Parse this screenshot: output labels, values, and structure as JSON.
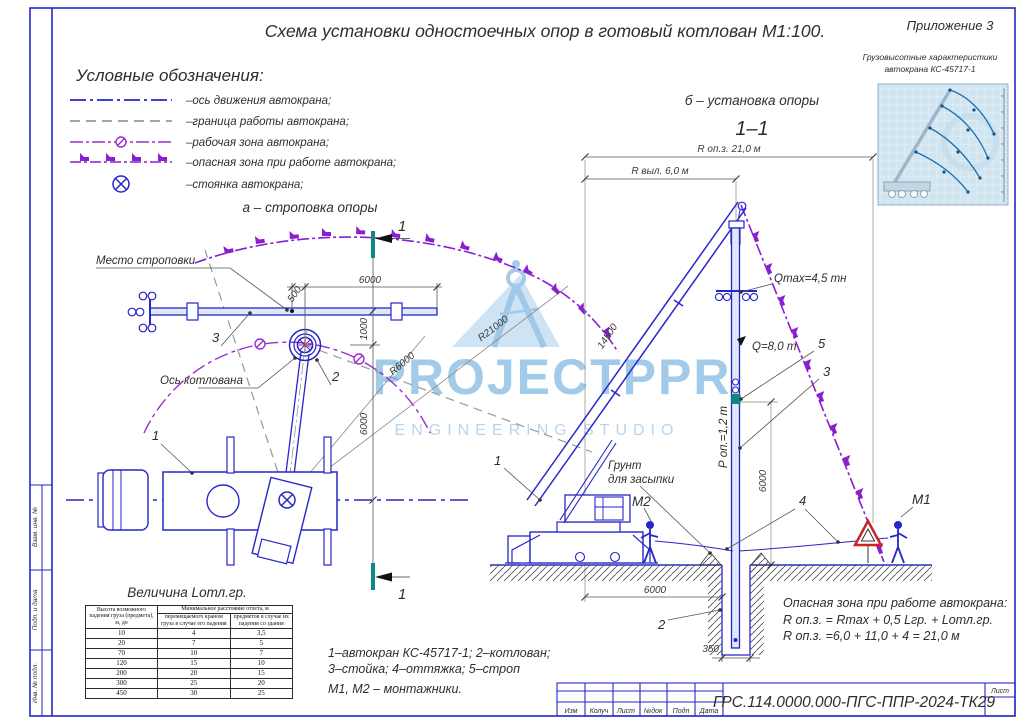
{
  "sheet": {
    "appendix": "Приложение 3",
    "title": "Схема установки одностоечных опор в готовый котлован М1:100.",
    "doc_number": "ГРС.114.0000.000-ПГС-ППР-2024-ТК29",
    "sheet_label": "Лист",
    "stamp_columns": [
      "Изм",
      "Колуч",
      "Лист",
      "№док",
      "Подп",
      "Дата"
    ],
    "side_fields": [
      "Взам. инв. №",
      "Подп. и дата",
      "Инв. № подл."
    ]
  },
  "legend": {
    "header": "Условные обозначения:",
    "items": [
      "–ось движения  автокрана;",
      "–граница работы автокрана;",
      "–рабочая зона автокрана;",
      "–опасная зона при работе автокрана;",
      "–стоянка автокрана;"
    ]
  },
  "crane_chart": {
    "title_line1": "Грузовысотные характеристики",
    "title_line2": "автокрана КС-45717-1"
  },
  "plan": {
    "subtitle": "а – строповка опоры",
    "sling_label": "Место строповки",
    "pit_axis_label": "Ось котлована",
    "dim_500": "500",
    "dim_6000_top": "6000",
    "dim_1000": "1000",
    "dim_6000_side": "6000",
    "r6000": "R6000",
    "r21000": "R21000",
    "callout_1": "1",
    "callout_2": "2",
    "callout_3": "3",
    "section_mark": "1"
  },
  "section": {
    "subtitle": "б – установка опоры",
    "view_label": "1–1",
    "dim_r_opz": "R оп.з. 21,0 м",
    "dim_r_vyl": "R выл. 6,0 м",
    "boom_length": "14500",
    "qmax": "Qmax=4,5 тн",
    "q_load": "Q=8,0 т",
    "p_op": "Р оп.=1,2 т",
    "soil_line1": "Грунт",
    "soil_line2": "для засыпки",
    "worker_m2": "М2",
    "worker_m1": "М1",
    "dim_6000_v": "6000",
    "dim_6000_h": "6000",
    "dim_350": "350",
    "callout_1": "1",
    "callout_2": "2",
    "callout_3": "3",
    "callout_4": "4",
    "callout_5": "5"
  },
  "danger_note": {
    "line1": "Опасная зона при работе автокрана:",
    "line2": "R оп.з. = Rmax + 0,5 Lгр. + Lотл.гр.",
    "line3": "R оп.з. =6,0 + 11,0 + 4 = 21,0 м"
  },
  "notes": {
    "line1": "1–автокран КС-45717-1; 2–котлован;",
    "line2": "3–стойка; 4–оттяжка; 5–строп",
    "line3": "М1, М2 – монтажники."
  },
  "offset_table": {
    "title": "Величина Lотл.гр.",
    "col1_header": "Высота возможного падения груза (предмета), м, до",
    "span_header": "Минимальное расстояние отлета, м",
    "col2_header": "перемещаемого краном груза в случае его падения",
    "col3_header": "предметов в случае их падения со здания",
    "rows": [
      [
        "10",
        "4",
        "3,5"
      ],
      [
        "20",
        "7",
        "5"
      ],
      [
        "70",
        "10",
        "7"
      ],
      [
        "120",
        "15",
        "10"
      ],
      [
        "200",
        "20",
        "15"
      ],
      [
        "300",
        "25",
        "20"
      ],
      [
        "450",
        "30",
        "25"
      ]
    ]
  },
  "watermark": {
    "line1": "PROJECTPPR",
    "line2": "ENGINEERING STUDIO"
  },
  "colors": {
    "line_blue": "#2626c9",
    "zone_purple": "#8a1fd0",
    "boundary_gray": "#999999",
    "section_teal": "#0a8a80",
    "danger_red": "#cc2222",
    "watermark_blue": "#8fc0e6"
  }
}
